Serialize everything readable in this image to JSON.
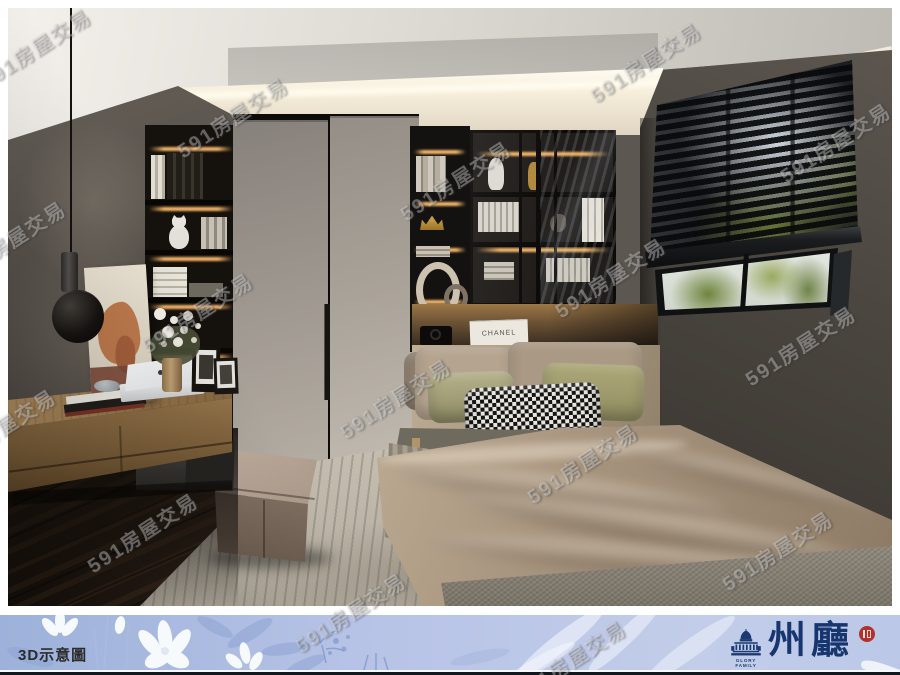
{
  "watermark": {
    "text": "591房屋交易"
  },
  "footer": {
    "label": "3D示意圖",
    "brand": {
      "subtitle": "GLORY FAMILY",
      "name": "州廳"
    },
    "colors": {
      "banner": "#b7c3e6",
      "navy": "#1c3a72",
      "seal": "#b23128",
      "bottom_bar": "#12161d"
    }
  },
  "decor": {
    "book_spine_label": "CHANEL"
  }
}
